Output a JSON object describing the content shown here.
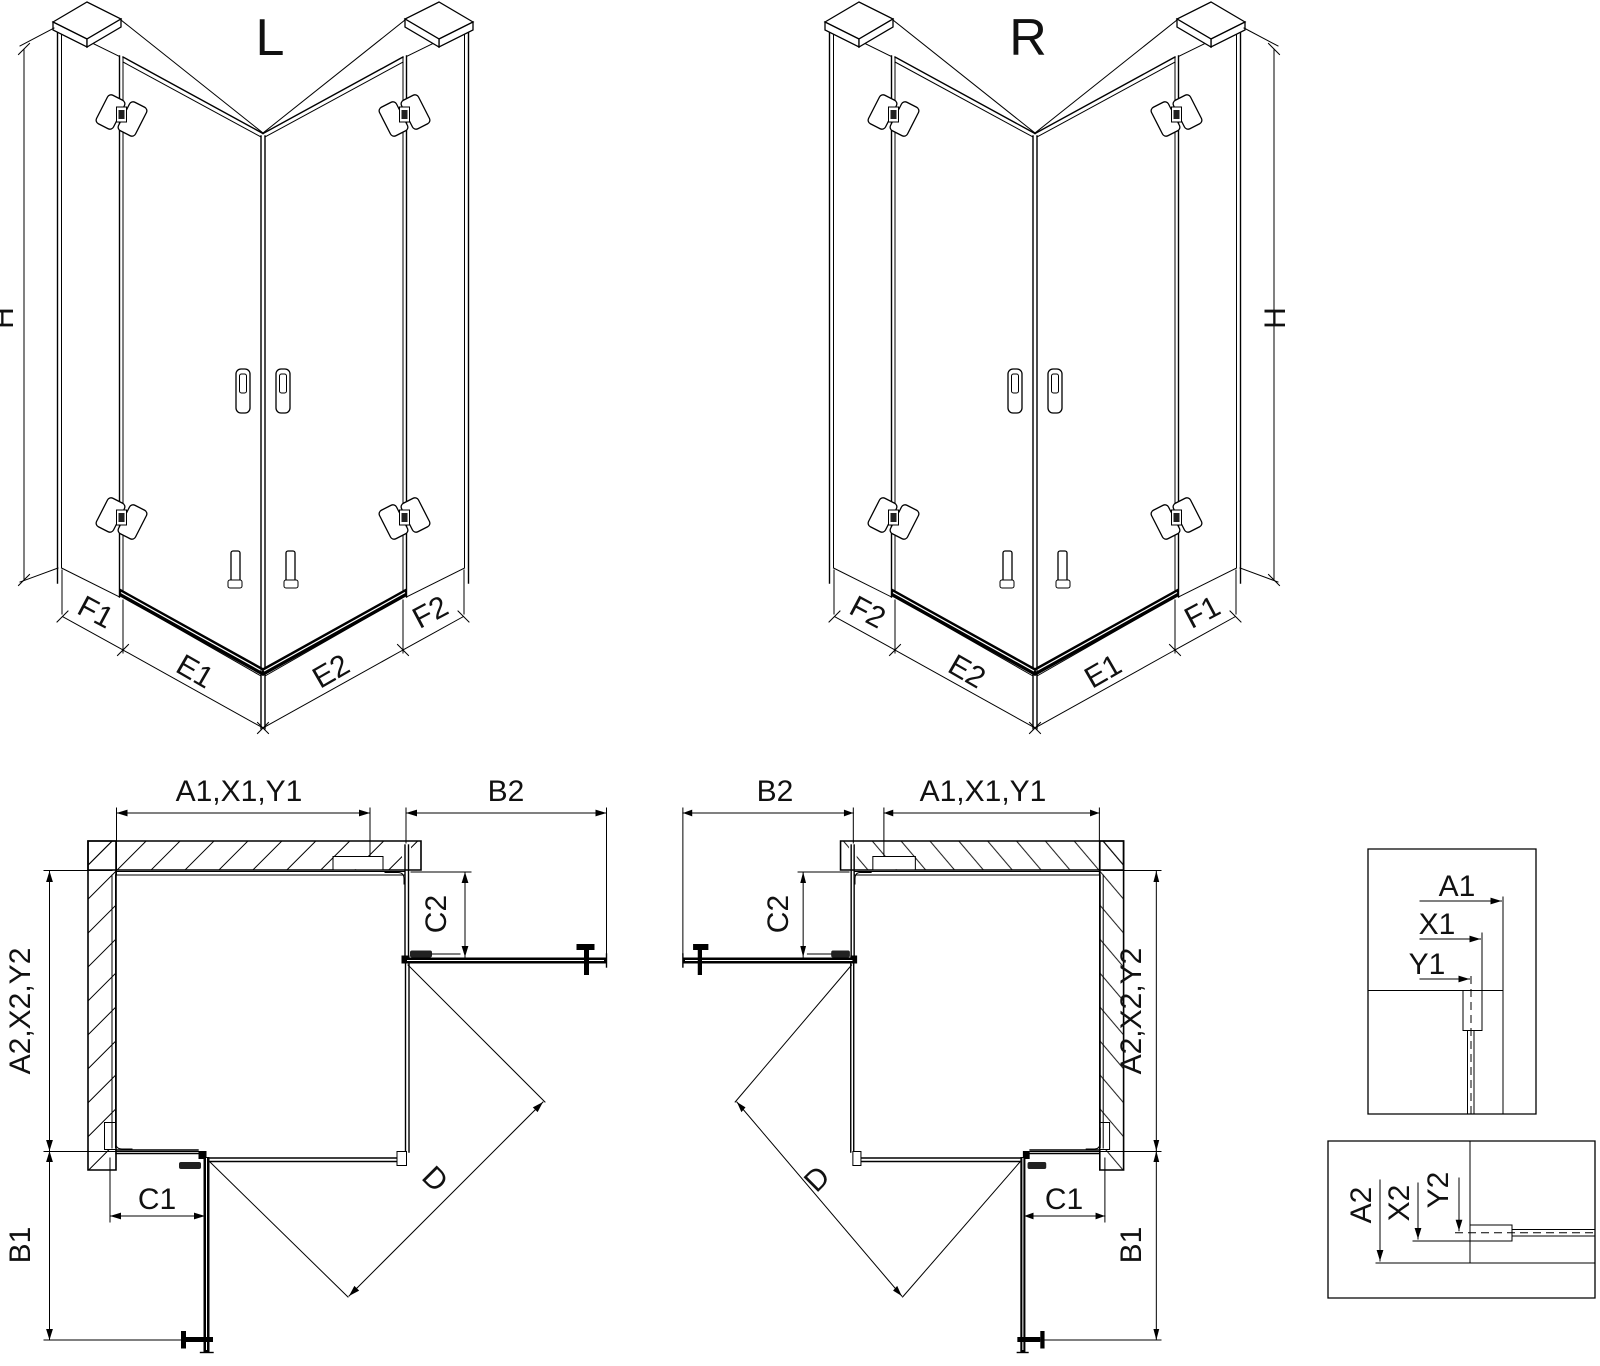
{
  "drawing": {
    "iso_left": {
      "title": "L",
      "height_label": "H",
      "segment_labels": [
        "F1",
        "E1",
        "E2",
        "F2"
      ]
    },
    "iso_right": {
      "title": "R",
      "height_label": "H",
      "segment_labels": [
        "F2",
        "E2",
        "E1",
        "F1"
      ]
    },
    "plan_left": {
      "top_width_label": "A1,X1,Y1",
      "side_door_label": "B2",
      "side_return_label": "C2",
      "depth_label": "A2,X2,Y2",
      "bottom_door_label": "B1",
      "bottom_return_label": "C1",
      "diagonal_label": "D"
    },
    "plan_right": {
      "side_door_label": "B2",
      "top_width_label": "A1,X1,Y1",
      "side_return_label": "C2",
      "depth_label": "A2,X2,Y2",
      "bottom_door_label": "B1",
      "bottom_return_label": "C1",
      "diagonal_label": "D"
    },
    "detail_top": {
      "labels": [
        "A1",
        "X1",
        "Y1"
      ]
    },
    "detail_bottom": {
      "labels": [
        "A2",
        "X2",
        "Y2"
      ]
    },
    "colors": {
      "line": "#000000",
      "text": "#111111",
      "background": "#ffffff"
    }
  }
}
